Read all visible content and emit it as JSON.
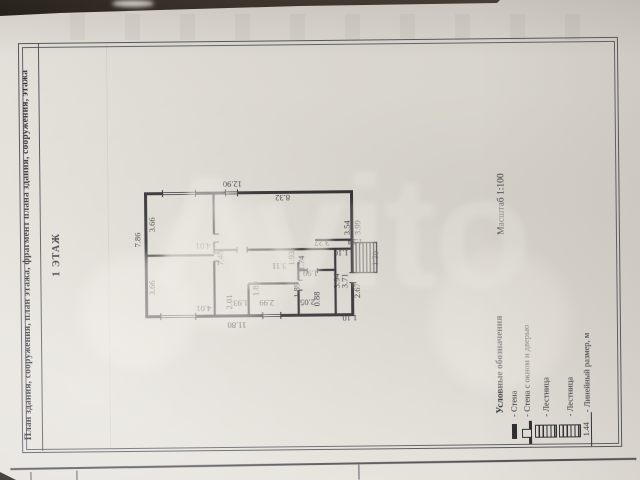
{
  "page": {
    "header_title": "План здания, сооружения, план этажа, фрагмент плана здания, сооружения, этажа",
    "floor_label": "1 ЭТАЖ",
    "scale_label": "Масштаб 1:100",
    "watermark_text": "Avito"
  },
  "legend": {
    "title": "Условные обозначения",
    "items": [
      {
        "symbol": "wall-icon",
        "label": "- Стена"
      },
      {
        "symbol": "wall-window-door-icon",
        "label": "- Стена с окном и дверью"
      },
      {
        "symbol": "stairs-icon",
        "label": "- Лестница"
      },
      {
        "symbol": "stairs-icon",
        "label": "- Лестница"
      },
      {
        "symbol": "linear-dimension-icon",
        "symbol_text": "1.44",
        "label": "- Линейный размер, м"
      }
    ]
  },
  "plan": {
    "dimension_labels": [
      {
        "text": "12.90",
        "x": 233,
        "y": 183,
        "rot": 180
      },
      {
        "text": "8.32",
        "x": 283,
        "y": 197,
        "rot": 180
      },
      {
        "text": "3.66",
        "x": 152,
        "y": 223,
        "rot": -90
      },
      {
        "text": "4.01",
        "x": 203,
        "y": 245,
        "rot": 180
      },
      {
        "text": "3.66",
        "x": 152,
        "y": 286,
        "rot": -90
      },
      {
        "text": "4.01",
        "x": 203,
        "y": 307,
        "rot": 180
      },
      {
        "text": "7.86",
        "x": 138,
        "y": 238,
        "rot": -90
      },
      {
        "text": "7.48",
        "x": 220,
        "y": 257,
        "rot": -90
      },
      {
        "text": "11.80",
        "x": 236,
        "y": 324,
        "rot": 180
      },
      {
        "text": "3.54",
        "x": 347,
        "y": 228,
        "rot": -90
      },
      {
        "text": "3.99",
        "x": 358,
        "y": 228,
        "rot": -90
      },
      {
        "text": "3.27",
        "x": 322,
        "y": 243,
        "rot": 180
      },
      {
        "text": "2.01",
        "x": 229,
        "y": 301,
        "rot": -90
      },
      {
        "text": "1.93",
        "x": 240,
        "y": 302,
        "rot": 180
      },
      {
        "text": "1.89",
        "x": 255,
        "y": 288,
        "rot": -90
      },
      {
        "text": "2.99",
        "x": 266,
        "y": 302,
        "rot": 180
      },
      {
        "text": "3.11",
        "x": 279,
        "y": 266,
        "rot": 180
      },
      {
        "text": "1.93",
        "x": 291,
        "y": 258,
        "rot": -90
      },
      {
        "text": "1.74",
        "x": 301,
        "y": 263,
        "rot": -90
      },
      {
        "text": "1.99",
        "x": 310,
        "y": 273,
        "rot": 180
      },
      {
        "text": "1.89",
        "x": 296,
        "y": 290,
        "rot": -90
      },
      {
        "text": "2.05",
        "x": 307,
        "y": 302,
        "rot": 180
      },
      {
        "text": "0.88",
        "x": 316,
        "y": 299,
        "rot": -90
      },
      {
        "text": "1.10",
        "x": 341,
        "y": 253,
        "rot": 180
      },
      {
        "text": "1.24",
        "x": 355,
        "y": 242,
        "rot": 180
      },
      {
        "text": "1.20",
        "x": 375,
        "y": 259,
        "rot": -90
      },
      {
        "text": "3.94",
        "x": 336,
        "y": 281,
        "rot": -90
      },
      {
        "text": "3.71",
        "x": 344,
        "y": 281,
        "rot": -90
      },
      {
        "text": "2.67",
        "x": 357,
        "y": 291,
        "rot": -90
      },
      {
        "text": "1.10",
        "x": 349,
        "y": 318,
        "rot": 180
      }
    ]
  },
  "colors": {
    "paper": "#e5e2db",
    "ink": "#2c2c30",
    "frame_line": "#55555b"
  }
}
